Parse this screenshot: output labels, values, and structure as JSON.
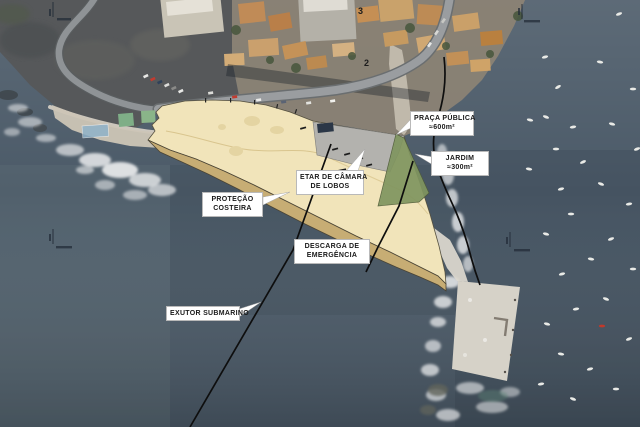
{
  "figure": {
    "type": "aerial-site-plan",
    "callouts": {
      "praca": {
        "line1": "PRAÇA PÚBLICA",
        "line2": "≈600m²"
      },
      "jardim": {
        "line1": "JARDIM",
        "line2": "≈300m²"
      },
      "etar": {
        "line1": "ETAR DE CÂMARA",
        "line2": "DE LOBOS"
      },
      "protecao": {
        "line1": "PROTEÇÃO",
        "line2": "COSTEIRA"
      },
      "descarga": {
        "line1": "DESCARGA DE",
        "line2": "EMERGÊNCIA"
      },
      "exutor": {
        "line1": "EXUTOR SUBMARINO"
      }
    },
    "map_numbers": [
      {
        "id": "point-3",
        "label": "3"
      },
      {
        "id": "point-2",
        "label": "2"
      }
    ],
    "colors": {
      "sea_mid": "#4b5a68",
      "platform": "#f1e4ba",
      "coastal_protection": "#c7ad74",
      "plaza": "#b3b2ae",
      "garden": "#80955f",
      "annotation_ink": "#0e0e0e",
      "label_bg": "#ffffff",
      "label_border": "#b9b9b9",
      "label_text": "#1a1a1a",
      "pier": "#d6d2c8",
      "building_dark": "#2b3747"
    },
    "boats": [
      [
        545,
        57,
        -15
      ],
      [
        600,
        62,
        10
      ],
      [
        558,
        87,
        -30
      ],
      [
        633,
        89,
        0
      ],
      [
        546,
        117,
        20
      ],
      [
        573,
        127,
        -10
      ],
      [
        612,
        124,
        15
      ],
      [
        637,
        149,
        -20
      ],
      [
        556,
        149,
        0
      ],
      [
        583,
        162,
        -25
      ],
      [
        529,
        169,
        10
      ],
      [
        561,
        189,
        -15
      ],
      [
        601,
        184,
        20
      ],
      [
        629,
        204,
        -10
      ],
      [
        571,
        214,
        0
      ],
      [
        546,
        234,
        15
      ],
      [
        611,
        239,
        -20
      ],
      [
        591,
        259,
        10
      ],
      [
        562,
        274,
        -15
      ],
      [
        633,
        269,
        0
      ],
      [
        606,
        299,
        20
      ],
      [
        576,
        309,
        -10
      ],
      [
        547,
        324,
        15
      ],
      [
        602,
        326,
        0,
        "#c0392b"
      ],
      [
        629,
        339,
        -20
      ],
      [
        561,
        354,
        10
      ],
      [
        590,
        369,
        -15
      ],
      [
        616,
        389,
        0
      ],
      [
        573,
        399,
        20
      ],
      [
        541,
        384,
        -10
      ],
      [
        619,
        14,
        -20
      ],
      [
        530,
        120,
        12
      ]
    ]
  }
}
